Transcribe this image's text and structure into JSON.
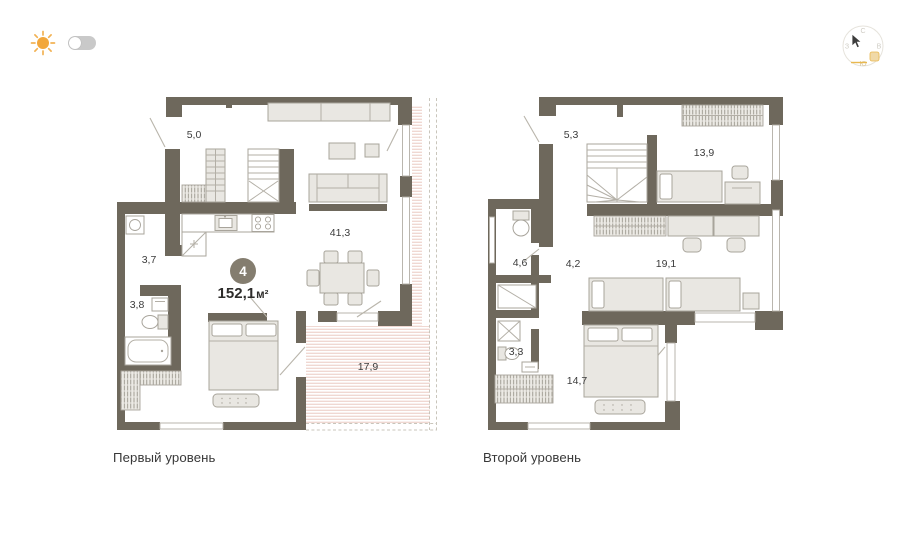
{
  "page": {
    "background_color": "#ffffff"
  },
  "controls": {
    "theme_toggle": {
      "state": "light",
      "sun_color": "#f2a73b",
      "track_color": "#c9c9c9"
    },
    "compass": {
      "north": "С",
      "east": "В",
      "south": "Ю",
      "west": "З",
      "accent_color": "#e9b84f"
    }
  },
  "summary": {
    "rooms_badge": "4",
    "total_area": "152,1",
    "area_unit": "м²",
    "badge_color": "#847d6f"
  },
  "levels": [
    {
      "caption": "Первый уровень",
      "rooms": [
        {
          "name": "hallway",
          "area": "5,0"
        },
        {
          "name": "bathroom",
          "area": "3,7"
        },
        {
          "name": "bathroom-2",
          "area": "3,8"
        },
        {
          "name": "living-kitchen",
          "area": "41,3"
        },
        {
          "name": "terrace",
          "area": "17,9"
        }
      ]
    },
    {
      "caption": "Второй уровень",
      "rooms": [
        {
          "name": "hallway",
          "area": "5,3"
        },
        {
          "name": "bedroom",
          "area": "13,9"
        },
        {
          "name": "bathroom",
          "area": "4,6"
        },
        {
          "name": "corridor",
          "area": "4,2"
        },
        {
          "name": "cabinet",
          "area": "19,1"
        },
        {
          "name": "shower-room",
          "area": "3,3"
        },
        {
          "name": "bedroom-2",
          "area": "14,7"
        }
      ]
    }
  ],
  "colors": {
    "wall": "#6e685c",
    "furniture_fill": "#e9e7e2",
    "furniture_stroke": "#a8a49b",
    "terrace_hatch": "#e8c4ba",
    "label_text": "#3c3c3c"
  }
}
